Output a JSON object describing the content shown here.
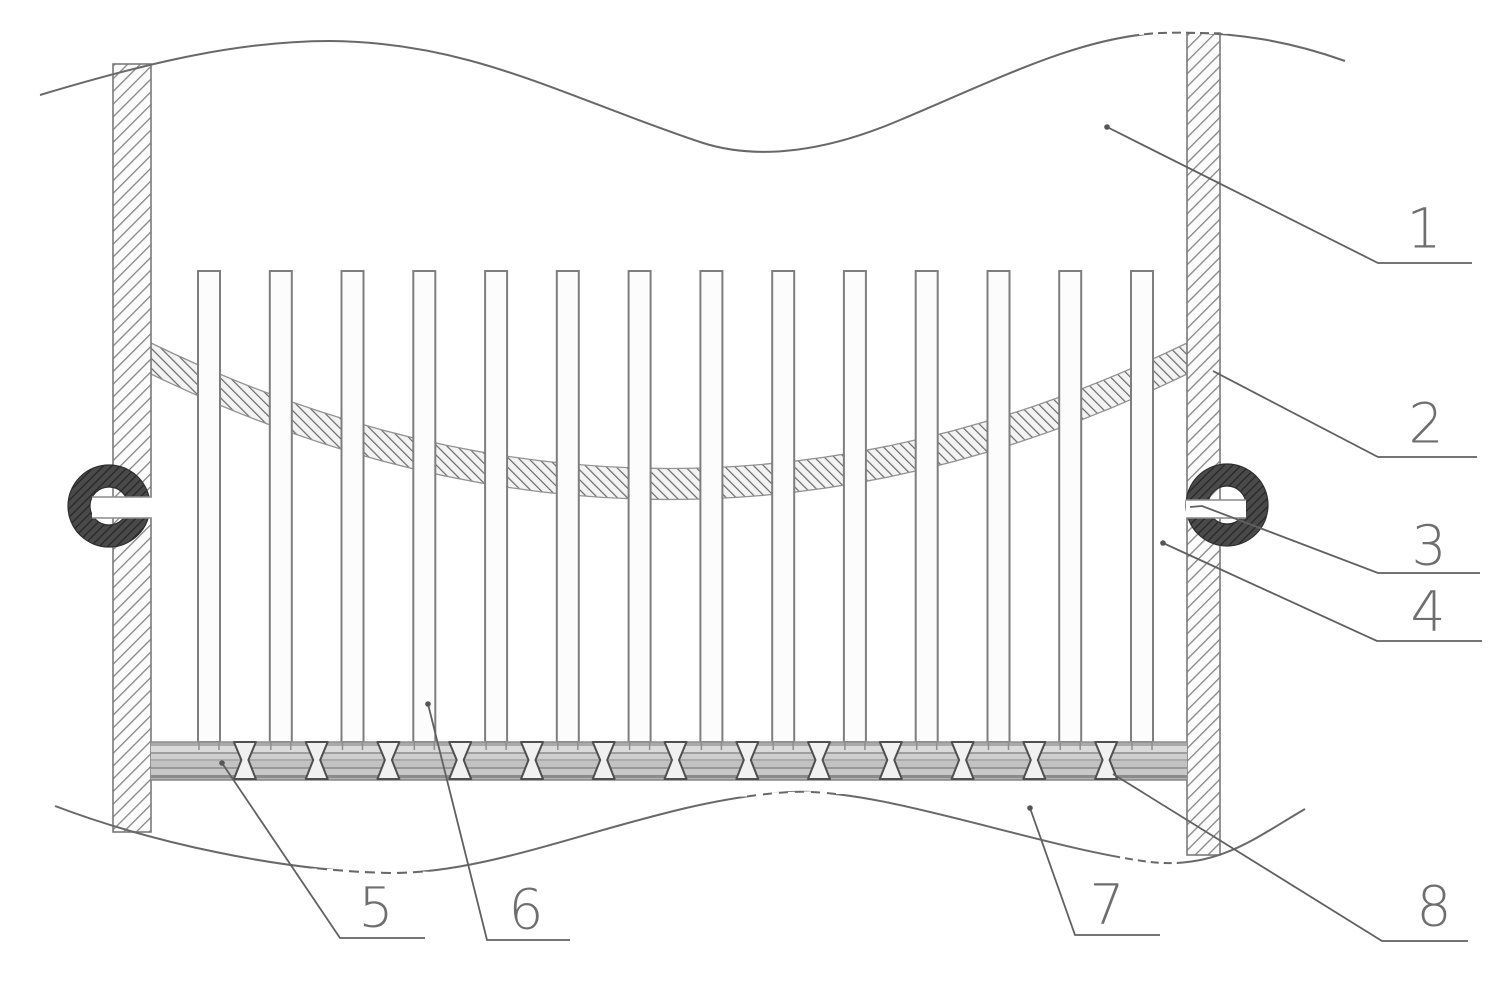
{
  "figure": {
    "kind": "patent-technical-drawing",
    "labels": [
      {
        "text": "1"
      },
      {
        "text": "2"
      },
      {
        "text": "3"
      },
      {
        "text": "4"
      },
      {
        "text": "5"
      },
      {
        "text": "6"
      },
      {
        "text": "7"
      },
      {
        "text": "8"
      }
    ],
    "colors": {
      "background": "#ffffff",
      "line": "#686868",
      "wall_hatch": "#858585",
      "band_hatch": "#6a6a6a",
      "ring_fill": "#454545",
      "plate_light": "#dadada",
      "plate_dark": "#8b8b8b"
    }
  }
}
